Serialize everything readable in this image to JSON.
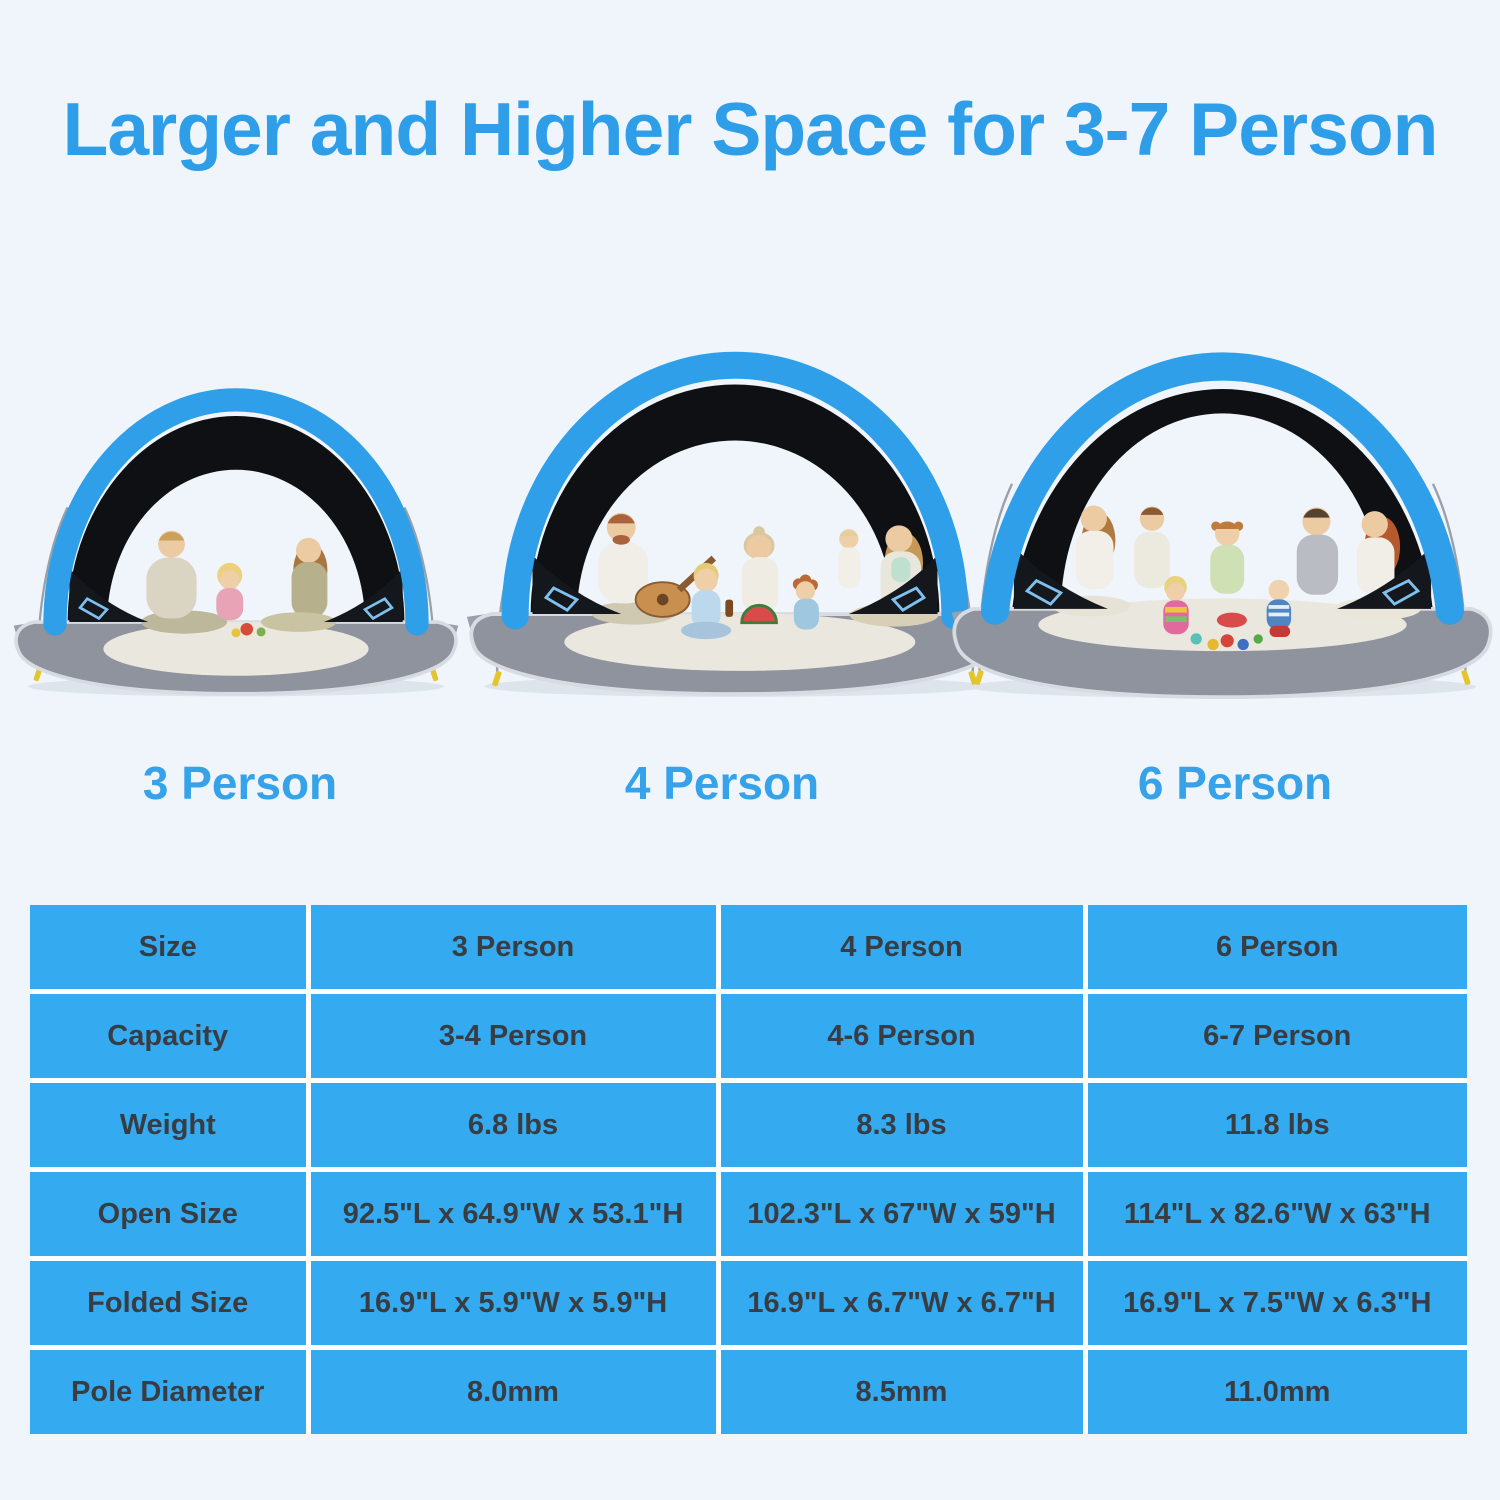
{
  "title": "Larger and Higher Space for 3-7 Person",
  "tents": [
    {
      "label": "3 Person",
      "scene": "family of four picnicking with fruit inside small blue pop-up beach tent"
    },
    {
      "label": "4 Person",
      "scene": "family of six with guitar and watermelon inside medium blue pop-up beach tent"
    },
    {
      "label": "6 Person",
      "scene": "family of seven with toddlers and beach toys inside large blue pop-up beach tent"
    }
  ],
  "table": {
    "rows": [
      {
        "label": "Size",
        "values": [
          "3 Person",
          "4 Person",
          "6 Person"
        ]
      },
      {
        "label": "Capacity",
        "values": [
          "3-4 Person",
          "4-6 Person",
          "6-7 Person"
        ]
      },
      {
        "label": "Weight",
        "values": [
          "6.8 lbs",
          "8.3 lbs",
          "11.8 lbs"
        ]
      },
      {
        "label": "Open Size",
        "values": [
          "92.5\"L x 64.9\"W x 53.1\"H",
          "102.3\"L x 67\"W x 59\"H",
          "114\"L x 82.6\"W x 63\"H"
        ]
      },
      {
        "label": "Folded Size",
        "values": [
          "16.9\"L x 5.9\"W x 5.9\"H",
          "16.9\"L x 6.7\"W x 6.7\"H",
          "16.9\"L x 7.5\"W x 6.3\"H"
        ]
      },
      {
        "label": "Pole Diameter",
        "values": [
          "8.0mm",
          "8.5mm",
          "11.0mm"
        ]
      }
    ]
  },
  "colors": {
    "accent_blue": "#2f9ee9",
    "table_cell_blue": "#34abf1",
    "table_text": "#383d44",
    "page_background": "#eff5fa",
    "tent_floor_gray": "#8e939d",
    "tent_interior_black": "#0e1014",
    "stake_yellow": "#e3c52d"
  }
}
